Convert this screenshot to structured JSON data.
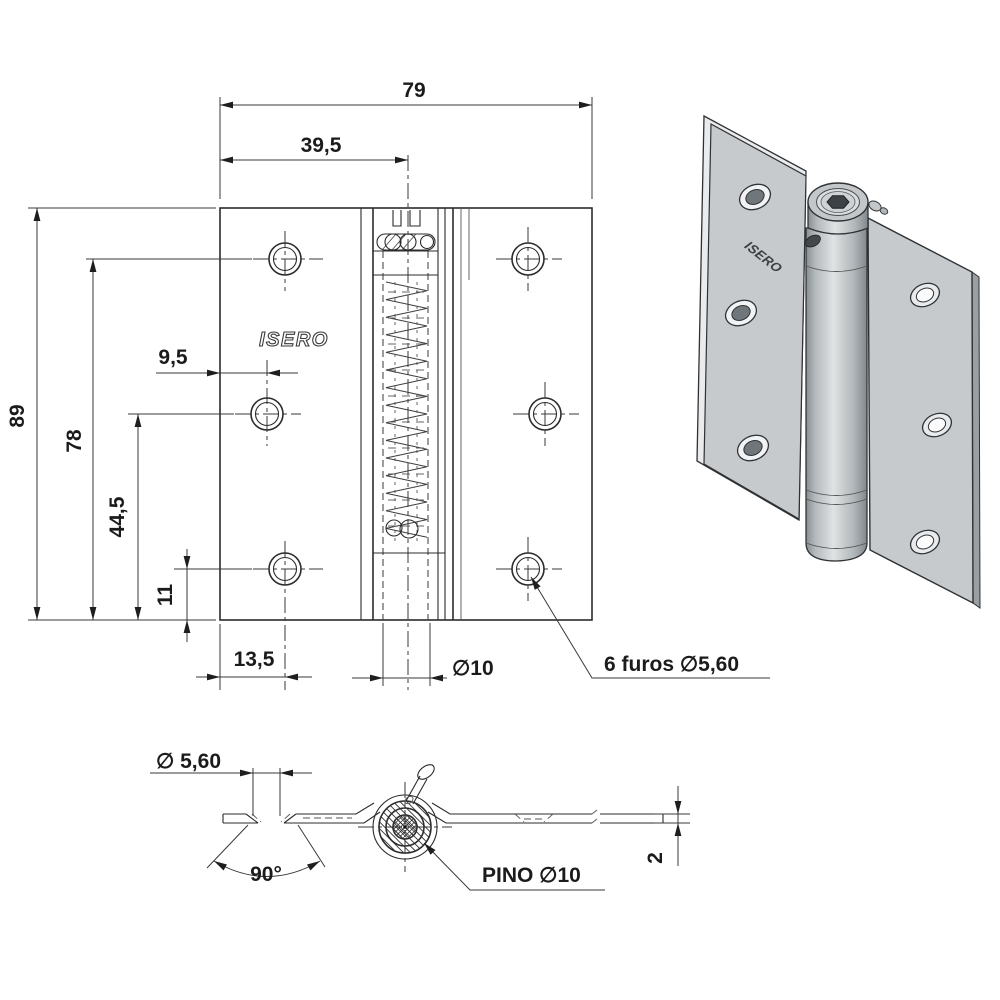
{
  "front_view": {
    "brand_label": "ISERO",
    "dim_overall_width": "79",
    "dim_pin_center": "39,5",
    "dim_overall_height": "89",
    "dim_holes_height": "78",
    "dim_middle_hole_inset": "9,5",
    "dim_middle_hole_height": "44,5",
    "dim_bottom_hole_height": "11",
    "dim_bottom_hole_inset": "13,5",
    "dim_knuckle_diameter": "∅10",
    "holes_callout": "6 furos ∅5,60"
  },
  "section_view": {
    "dim_hole_diameter": "∅ 5,60",
    "dim_countersink_angle": "90°",
    "pin_callout": "PINO ∅10",
    "dim_plate_thickness": "2"
  },
  "iso_view": {
    "brand_label": "ISERO"
  },
  "colors": {
    "line": "#2b2b2b",
    "text": "#1b1b1b",
    "metal_face": "#c6cacc",
    "metal_light": "#e9ebec",
    "metal_dark": "#8e959a",
    "hex_socket": "#3d4246",
    "background": "#ffffff"
  }
}
